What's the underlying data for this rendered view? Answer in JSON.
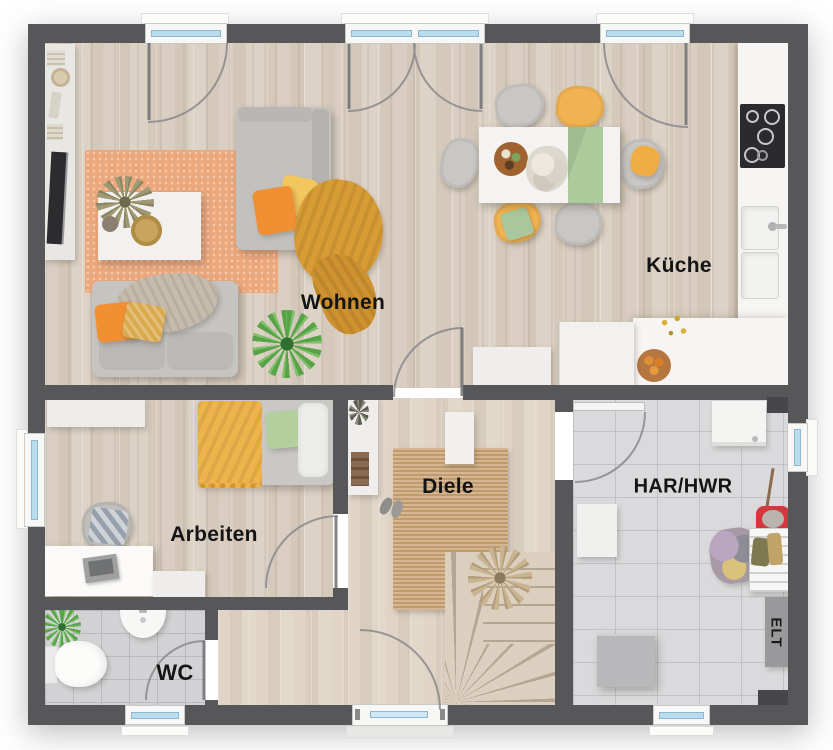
{
  "rooms": [
    {
      "id": "wohnen",
      "label": "Wohnen"
    },
    {
      "id": "kueche",
      "label": "Küche"
    },
    {
      "id": "arbeiten",
      "label": "Arbeiten"
    },
    {
      "id": "diele",
      "label": "Diele"
    },
    {
      "id": "har_hwr",
      "label": "HAR/HWR"
    },
    {
      "id": "wc",
      "label": "WC"
    },
    {
      "id": "elt",
      "label": "ELT"
    }
  ],
  "colors": {
    "wall": "#57575a",
    "wood_floor": "#d7ccbf",
    "tile_floor": "#d9d9db",
    "rug_orange": "#eca87d",
    "rug_jute": "#c8a273",
    "accent_orange": "#f18f33",
    "accent_yellow": "#f2c05a",
    "accent_green": "#accb9d",
    "plant_green": "#57a348",
    "window_glass": "#b9dcef"
  }
}
